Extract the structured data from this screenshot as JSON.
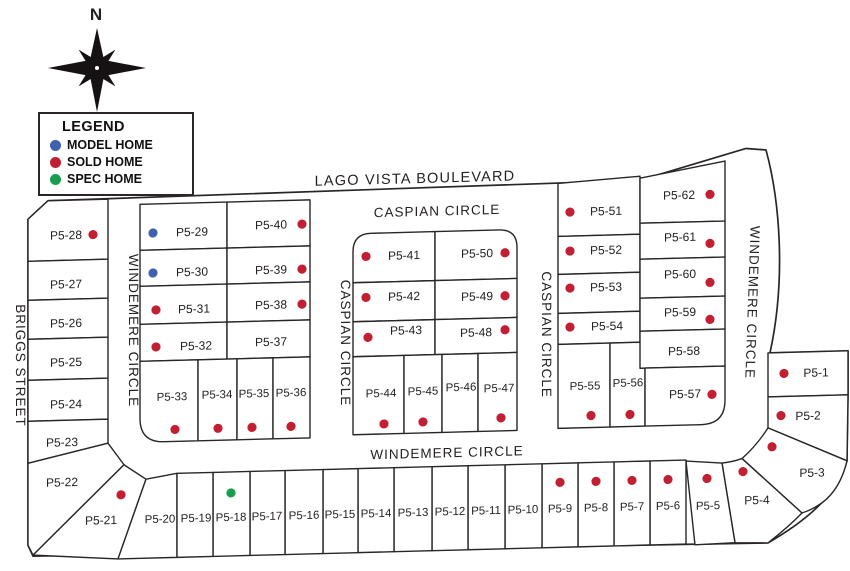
{
  "compass": {
    "north_label": "N"
  },
  "legend": {
    "title": "LEGEND",
    "items": [
      {
        "label": "MODEL HOME",
        "color_key": "model"
      },
      {
        "label": "SOLD HOME",
        "color_key": "sold"
      },
      {
        "label": "SPEC HOME",
        "color_key": "spec"
      }
    ]
  },
  "colors": {
    "model": "#3f62ae",
    "sold": "#c22032",
    "spec": "#179e4e",
    "line": "#2a2627"
  },
  "streets": {
    "lago_vista_boulevard": "LAGO VISTA BOULEVARD",
    "caspian_circle_top": "CASPIAN CIRCLE",
    "caspian_circle_west": "CASPIAN CIRCLE",
    "caspian_circle_east": "CASPIAN CIRCLE",
    "windemere_circle_west": "WINDEMERE CIRCLE",
    "windemere_circle_east": "WINDEMERE CIRCLE",
    "windemere_circle_south": "WINDEMERE CIRCLE",
    "briggs_street": "BRIGGS STREET"
  },
  "lots": {
    "P5-1": {
      "label": "P5-1",
      "status": "sold"
    },
    "P5-2": {
      "label": "P5-2",
      "status": "sold"
    },
    "P5-3": {
      "label": "P5-3",
      "status": "sold"
    },
    "P5-4": {
      "label": "P5-4",
      "status": "sold"
    },
    "P5-5": {
      "label": "P5-5",
      "status": "sold"
    },
    "P5-6": {
      "label": "P5-6",
      "status": "sold"
    },
    "P5-7": {
      "label": "P5-7",
      "status": "sold"
    },
    "P5-8": {
      "label": "P5-8",
      "status": "sold"
    },
    "P5-9": {
      "label": "P5-9",
      "status": "sold"
    },
    "P5-10": {
      "label": "P5-10",
      "status": "available"
    },
    "P5-11": {
      "label": "P5-11",
      "status": "available"
    },
    "P5-12": {
      "label": "P5-12",
      "status": "available"
    },
    "P5-13": {
      "label": "P5-13",
      "status": "available"
    },
    "P5-14": {
      "label": "P5-14",
      "status": "available"
    },
    "P5-15": {
      "label": "P5-15",
      "status": "available"
    },
    "P5-16": {
      "label": "P5-16",
      "status": "available"
    },
    "P5-17": {
      "label": "P5-17",
      "status": "available"
    },
    "P5-18": {
      "label": "P5-18",
      "status": "spec"
    },
    "P5-19": {
      "label": "P5-19",
      "status": "available"
    },
    "P5-20": {
      "label": "P5-20",
      "status": "available"
    },
    "P5-21": {
      "label": "P5-21",
      "status": "sold"
    },
    "P5-22": {
      "label": "P5-22",
      "status": "available"
    },
    "P5-23": {
      "label": "P5-23",
      "status": "available"
    },
    "P5-24": {
      "label": "P5-24",
      "status": "available"
    },
    "P5-25": {
      "label": "P5-25",
      "status": "available"
    },
    "P5-26": {
      "label": "P5-26",
      "status": "available"
    },
    "P5-27": {
      "label": "P5-27",
      "status": "available"
    },
    "P5-28": {
      "label": "P5-28",
      "status": "sold"
    },
    "P5-29": {
      "label": "P5-29",
      "status": "model"
    },
    "P5-30": {
      "label": "P5-30",
      "status": "model"
    },
    "P5-31": {
      "label": "P5-31",
      "status": "sold"
    },
    "P5-32": {
      "label": "P5-32",
      "status": "sold"
    },
    "P5-33": {
      "label": "P5-33",
      "status": "sold"
    },
    "P5-34": {
      "label": "P5-34",
      "status": "sold"
    },
    "P5-35": {
      "label": "P5-35",
      "status": "sold"
    },
    "P5-36": {
      "label": "P5-36",
      "status": "sold"
    },
    "P5-37": {
      "label": "P5-37",
      "status": "available"
    },
    "P5-38": {
      "label": "P5-38",
      "status": "sold"
    },
    "P5-39": {
      "label": "P5-39",
      "status": "sold"
    },
    "P5-40": {
      "label": "P5-40",
      "status": "sold"
    },
    "P5-41": {
      "label": "P5-41",
      "status": "sold"
    },
    "P5-42": {
      "label": "P5-42",
      "status": "sold"
    },
    "P5-43": {
      "label": "P5-43",
      "status": "sold"
    },
    "P5-44": {
      "label": "P5-44",
      "status": "sold"
    },
    "P5-45": {
      "label": "P5-45",
      "status": "sold"
    },
    "P5-46": {
      "label": "P5-46",
      "status": "available"
    },
    "P5-47": {
      "label": "P5-47",
      "status": "sold"
    },
    "P5-48": {
      "label": "P5-48",
      "status": "sold"
    },
    "P5-49": {
      "label": "P5-49",
      "status": "sold"
    },
    "P5-50": {
      "label": "P5-50",
      "status": "sold"
    },
    "P5-51": {
      "label": "P5-51",
      "status": "sold"
    },
    "P5-52": {
      "label": "P5-52",
      "status": "sold"
    },
    "P5-53": {
      "label": "P5-53",
      "status": "sold"
    },
    "P5-54": {
      "label": "P5-54",
      "status": "sold"
    },
    "P5-55": {
      "label": "P5-55",
      "status": "sold"
    },
    "P5-56": {
      "label": "P5-56",
      "status": "sold"
    },
    "P5-57": {
      "label": "P5-57",
      "status": "sold"
    },
    "P5-58": {
      "label": "P5-58",
      "status": "available"
    },
    "P5-59": {
      "label": "P5-59",
      "status": "sold"
    },
    "P5-60": {
      "label": "P5-60",
      "status": "sold"
    },
    "P5-61": {
      "label": "P5-61",
      "status": "sold"
    },
    "P5-62": {
      "label": "P5-62",
      "status": "sold"
    }
  }
}
